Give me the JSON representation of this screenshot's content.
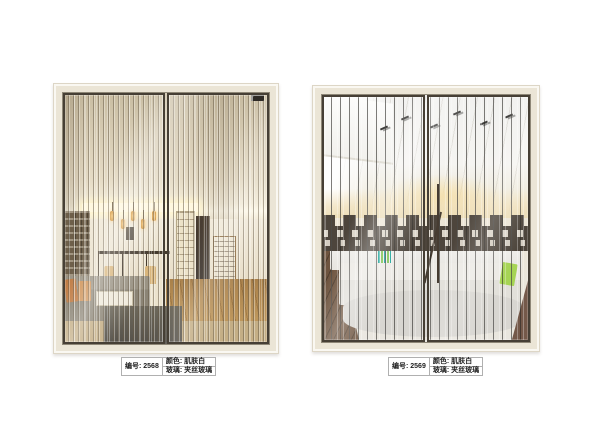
{
  "page": {
    "background": "#ffffff"
  },
  "products": [
    {
      "name": "sliding-door-2568",
      "scene": "warm beige living room with pendant lamps, gray sofa and wood floor behind dense wired-glass stripes",
      "spec": {
        "code": "编号: 2568",
        "color": "颜色: 肌肤白",
        "glass": "玻璃: 夹丝玻璃"
      }
    },
    {
      "name": "sliding-door-2569",
      "scene": "modern white lounge with track lights, white sofas and dark deco band behind sparse wired-glass stripes",
      "spec": {
        "code": "编号: 2569",
        "color": "颜色: 肌肤白",
        "glass": "玻璃: 夹丝玻璃"
      }
    }
  ],
  "colors": {
    "background": "#ffffff",
    "door_frame": "#ebe5d6",
    "door_frame_inner_line": "#8e8777",
    "panel_frame": "#463f35",
    "deco_band": "#4d453c",
    "pillow_orange": "#c07c44",
    "pillow_green": "#a6d454",
    "pillow_teal_stripe": "#17a398",
    "stripe_left_tint": "rgba(101,88,68,0.5)",
    "stripe_right_tint": "rgba(40,38,34,0.6)",
    "label_border": "#b0b0b0",
    "label_text": "#222222"
  }
}
